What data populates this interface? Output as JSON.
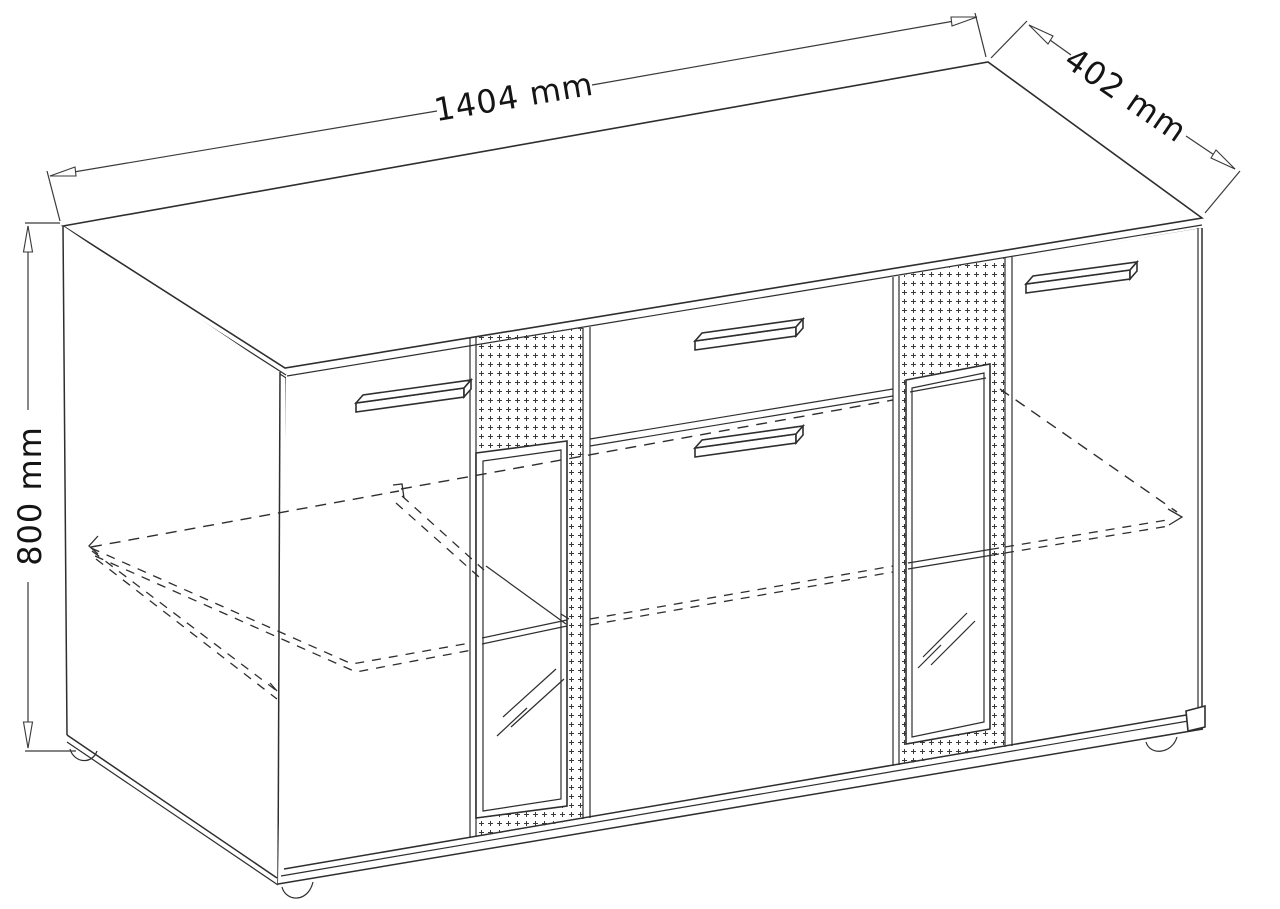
{
  "drawing": {
    "kind": "furniture-dimension-diagram",
    "item": "sideboard with two doors, central drawer and door, two dotted vitrine strips with glass windows, hidden shelves shown dashed",
    "background_color": "#ffffff",
    "line_color": "#2e2e2e",
    "dimensions": {
      "width": {
        "label": "1404 mm",
        "value": 1404,
        "unit": "mm"
      },
      "depth": {
        "label": "402 mm",
        "value": 402,
        "unit": "mm"
      },
      "height": {
        "label": "800 mm",
        "value": 800,
        "unit": "mm"
      }
    }
  }
}
